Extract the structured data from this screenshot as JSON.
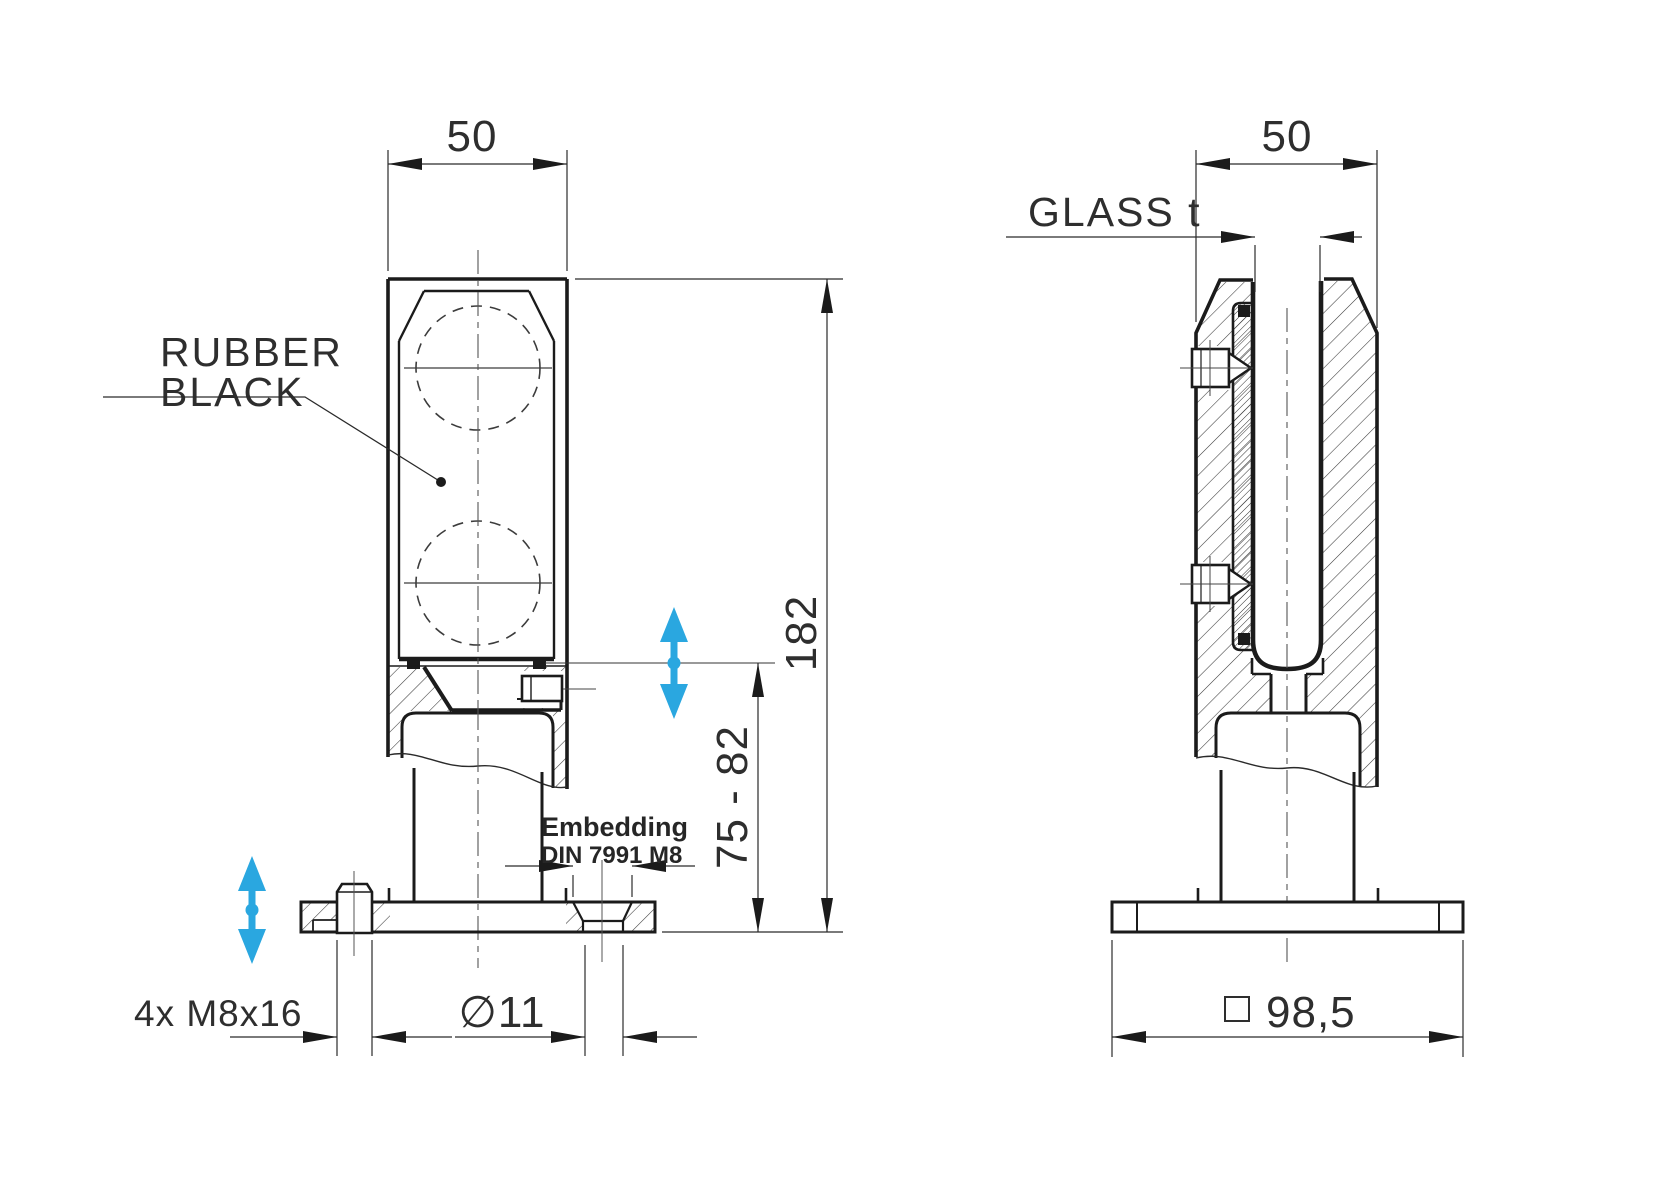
{
  "drawing": {
    "type": "technical-drawing",
    "line_color": "#1b1b1b",
    "accent_color": "#2aa7e0",
    "accent_text_color": "#1795d6",
    "front": {
      "width_dim": "50",
      "height_dim": "182",
      "adjust_dim": "75 - 82",
      "bolt_dim": "4x M8x16",
      "hole_dim": "∅11",
      "rubber_label_line1": "RUBBER",
      "rubber_label_line2": "BLACK",
      "embedding_line1": "Embedding",
      "embedding_line2": "DIN 7991 M8"
    },
    "side": {
      "width_dim": "50",
      "glass_label": "GLASS t",
      "base_dim": "98,5"
    }
  }
}
